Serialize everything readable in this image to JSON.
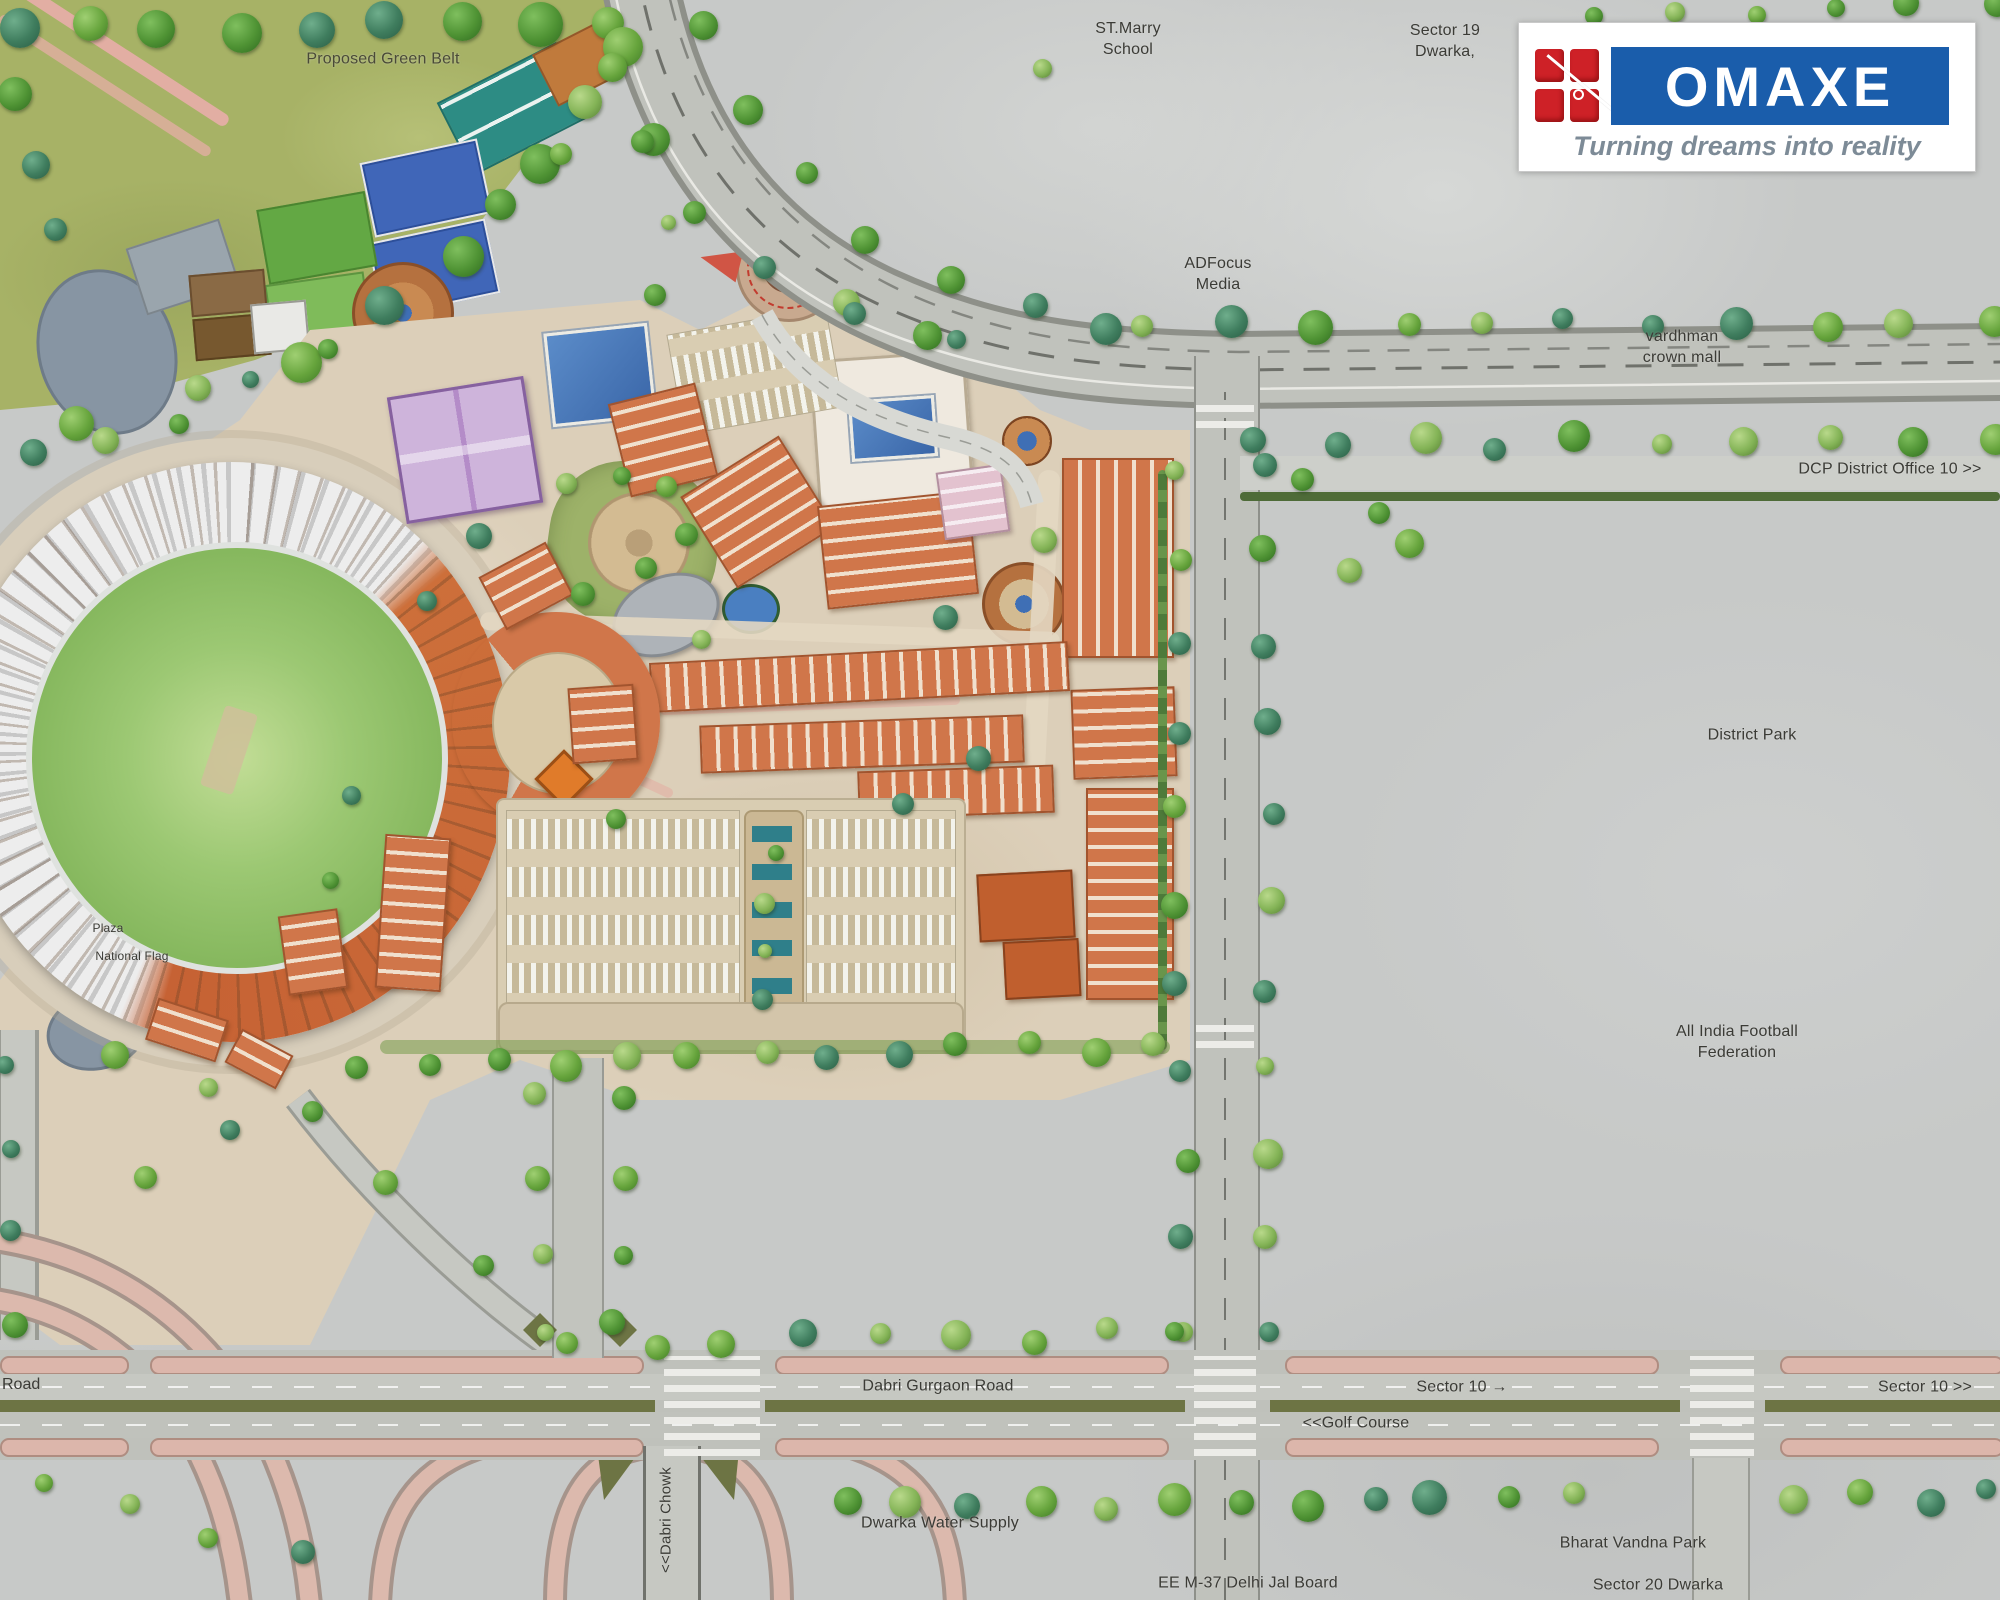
{
  "logo": {
    "brand": "OMAXE",
    "tagline": "Turning dreams into reality"
  },
  "labels": {
    "proposed_green_belt": "Proposed Green Belt",
    "st_marry_school": "ST.Marry\nSchool",
    "sector_19_dwarka": "Sector 19\nDwarka,",
    "adfocus_media": "ADFocus\nMedia",
    "vardhman_crown_mall": "vardhman\ncrown mall",
    "dcp_district_office": "DCP District Office 10 >>",
    "district_park": "District Park",
    "all_india_football_federation": "All India Football\nFederation",
    "dabri_gurgaon_road": "Dabri Gurgaon Road",
    "sector_10_mid": "Sector 10 →",
    "golf_course": "<<Golf Course",
    "sector_10_right": "Sector 10 >>",
    "road_left": "Road",
    "dabri_chowk": "<<Dabri Chowk",
    "dwarka_water_supply": "Dwarka Water Supply",
    "ee_m37_delhi_jal_board": "EE M-37 Delhi Jal Board",
    "bharat_vandna_park": "Bharat Vandna Park",
    "sector_20_dwarka": "Sector 20 Dwarka",
    "plaza": "Plaza",
    "national_flag": "National Flag"
  },
  "colors": {
    "brand_blue": "#1a5dab",
    "brand_red": "#ce2127",
    "green_belt": "#a7b266",
    "building_orange": "#d0764a",
    "road_gray": "#c2c4be",
    "median_olive": "#6d7444",
    "water_blue": "#4a7fc1"
  }
}
